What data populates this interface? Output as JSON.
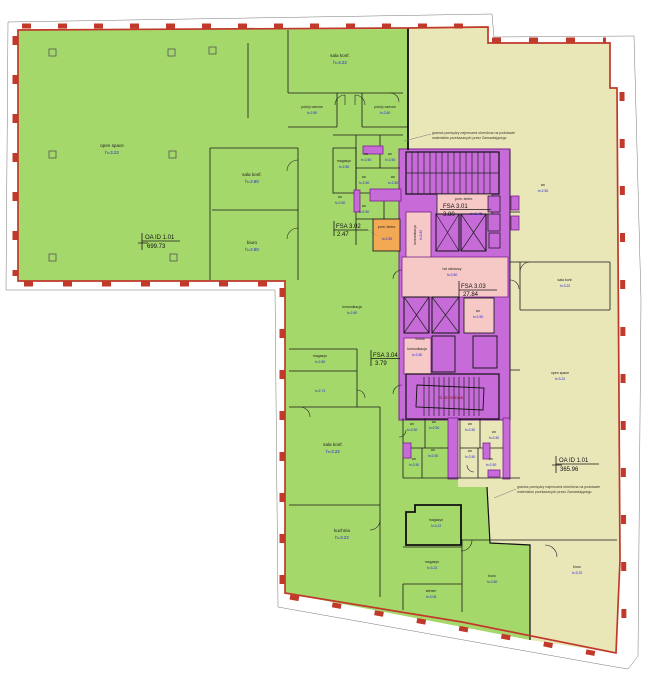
{
  "plan_title": "floor plan – level 3 tenant layout",
  "rooms": {
    "open_space": {
      "name": "open space",
      "h": "h=3.22"
    },
    "sala_konf_322": {
      "name": "sala konf.",
      "h": "h=3.22"
    },
    "sala_konf_280": {
      "name": "sala konf.",
      "h": "h=2.80"
    },
    "pokoj_rozmow": {
      "name": "pokój rozmów",
      "h": "h=2.80"
    },
    "biuro_280": {
      "name": "biuro",
      "h": "h=2.80"
    },
    "biuro_322": {
      "name": "biuro",
      "h": "h=3.22"
    },
    "magazyn_280": {
      "name": "magazyn",
      "h": "h=2.80"
    },
    "magazyn_322": {
      "name": "magazyn",
      "h": "h=3.22"
    },
    "wc": {
      "name": "wc",
      "h": "h=2.50"
    },
    "pom_techn_250": {
      "name": "pom. techn.",
      "h": "h=2.50"
    },
    "pom_techn": {
      "name": "pom. techn."
    },
    "komunikacja_280": {
      "name": "komunikacja",
      "h": "h=2.80"
    },
    "hol_windowy": {
      "name": "hol windowy",
      "h": "h=2.80"
    },
    "winda": {
      "name": "winda"
    },
    "kl_schodowa": {
      "name": "kl. schodowa"
    },
    "kuchnia_322": {
      "name": "kuchnia",
      "h": "h=3.22"
    },
    "serwer": {
      "name": "serwer",
      "h": "h=3.08"
    },
    "room_273": {
      "h": "h=2.73"
    }
  },
  "areas": {
    "oa_green": {
      "label": "OA ID 1.01",
      "value": "699.73"
    },
    "oa_yellow": {
      "label": "OA ID 1.01",
      "value": "365.96"
    },
    "fsa_3_01": {
      "label": "FSA 3.01",
      "value": "3.80",
      "h": "h=3.45"
    },
    "fsa_3_02": {
      "label": "FSA 3.02",
      "value": "2.47"
    },
    "fsa_3_03": {
      "label": "FSA 3.03",
      "value": "27.84"
    },
    "fsa_3_04": {
      "label": "FSA 3.04",
      "value": "3.79"
    }
  },
  "notes": {
    "boundary_line1": "granica pomiędzy najemcami określona na podstawie",
    "boundary_line2": "materiałów przekazanych przez Zamawiającego"
  },
  "colors": {
    "tenant_green": "#a5d86b",
    "tenant_yellow": "#e9e6b8",
    "core_purple": "#c76bd9",
    "corridor_pink": "#f6c9c7",
    "tech_orange": "#f3a953",
    "boundary_red": "#c0392b"
  }
}
